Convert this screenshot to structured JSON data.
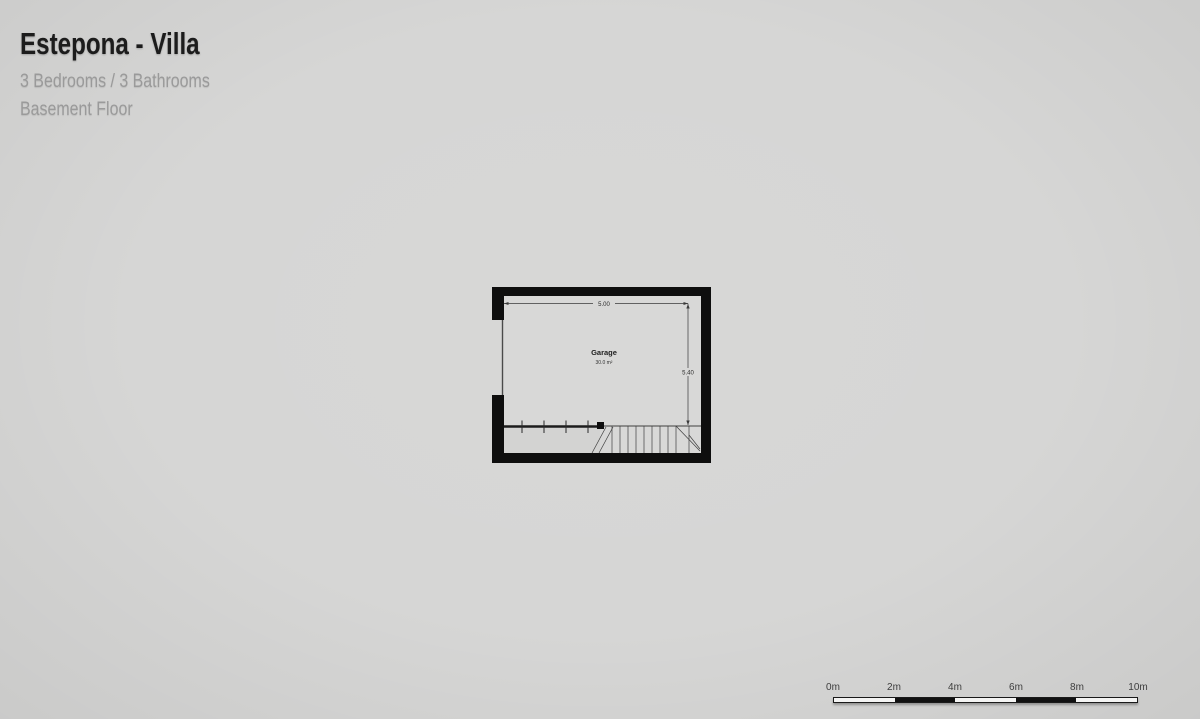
{
  "header": {
    "title": "Estepona - Villa",
    "subtitle": "3 Bedrooms / 3 Bathrooms",
    "floor_label": "Basement Floor"
  },
  "floor_plan": {
    "room_label": "Garage",
    "room_area": "30.0 m²",
    "width_dimension": "5.00",
    "height_dimension": "5.40"
  },
  "scale_bar": {
    "labels": [
      "0m",
      "2m",
      "4m",
      "6m",
      "8m",
      "10m"
    ]
  },
  "colors": {
    "background": "#d6d6d5",
    "plan_interior": "#d8d8d7",
    "wall": "#0e0e0e",
    "thin_line": "#3f3f3f",
    "title_text": "#1c1c1c",
    "subtitle_text": "#9a9a9a",
    "scale_label_text": "#3d3d3d"
  }
}
